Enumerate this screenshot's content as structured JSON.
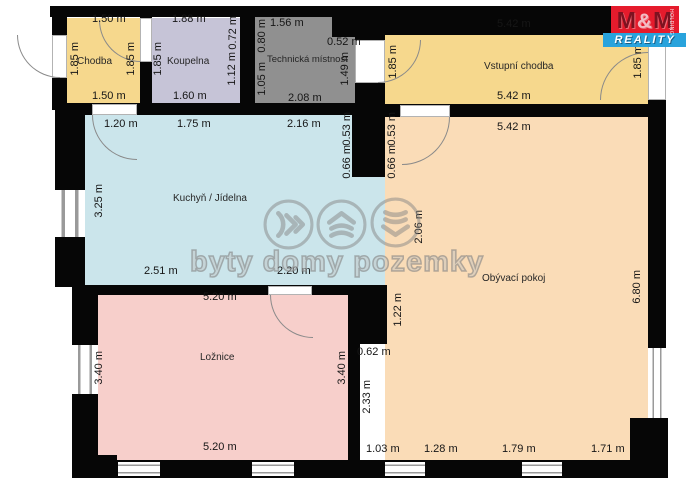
{
  "brand": {
    "logo_m1": "M",
    "logo_amp": "&",
    "logo_m2": "M",
    "logo_bottom": "REALITY",
    "logo_side": "HOLDING"
  },
  "watermark": {
    "text": "byty domy pozemky",
    "icons": [
      "waves-right-icon",
      "roof-waves-icon",
      "waves-down-icon"
    ]
  },
  "rooms": {
    "chodba": {
      "name": "Chodba",
      "dim_top": "1.50 m",
      "dim_left": "1.85 m",
      "dim_right": "1.85 m",
      "dim_bottom": "1.50 m"
    },
    "koupelna": {
      "name": "Koupelna",
      "dim_top": "1.88 m",
      "dim_top_right": "0.72 m",
      "dim_left": "1.85 m",
      "dim_right": "1.12 m",
      "dim_bottom": "1.60 m"
    },
    "technicka_mistnost": {
      "name": "Technická místnost",
      "dim_top": "1.56 m",
      "dim_left_top": "0.80 m",
      "dim_notch": "0.52 m",
      "dim_left_bottom": "1.05 m",
      "dim_right": "1.49 m",
      "dim_bottom": "2.08 m"
    },
    "vstupni_chodba": {
      "name": "Vstupní chodba",
      "dim_top": "5.42 m",
      "dim_left": "1.85 m",
      "dim_right": "1.85 m",
      "dim_bottom": "5.42 m"
    },
    "kuchyn_jidelna": {
      "name": "Kuchyň / Jídelna",
      "dim_top_1": "1.20 m",
      "dim_top_2": "1.75 m",
      "dim_top_3": "2.16 m",
      "dim_left": "3.25 m",
      "dim_right_upper": "0.53 m",
      "dim_right_lower": "0.66 m",
      "dim_bottom_1": "2.51 m",
      "dim_bottom_2": "2.20 m"
    },
    "obyvaci_pokoj": {
      "name": "Obývací pokoj",
      "dim_top": "5.42 m",
      "dim_left_upper": "0.53 m",
      "dim_left_lower": "0.66 m",
      "dim_opening": "2.06 m",
      "dim_wall_stub_height": "1.22 m",
      "dim_wall_stub_width": "0.62 m",
      "dim_left_bottom": "2.33 m",
      "dim_right": "6.80 m",
      "dim_bottom_1": "1.03 m",
      "dim_bottom_2": "1.28 m",
      "dim_bottom_3": "1.79 m",
      "dim_bottom_4": "1.71 m"
    },
    "loznice": {
      "name": "Ložnice",
      "dim_top": "5.20 m",
      "dim_left": "3.40 m",
      "dim_right": "3.40 m",
      "dim_bottom": "5.20 m"
    }
  },
  "colors": {
    "hallway": "#f6d88d",
    "bathroom": "#c6c4d7",
    "technical": "#909090",
    "kitchen": "#cbe5eb",
    "living": "#fadcb7",
    "bedroom": "#f7cfcb",
    "wall": "#060606",
    "logo_red": "#e51b2c",
    "logo_blue": "#29a3dc"
  }
}
